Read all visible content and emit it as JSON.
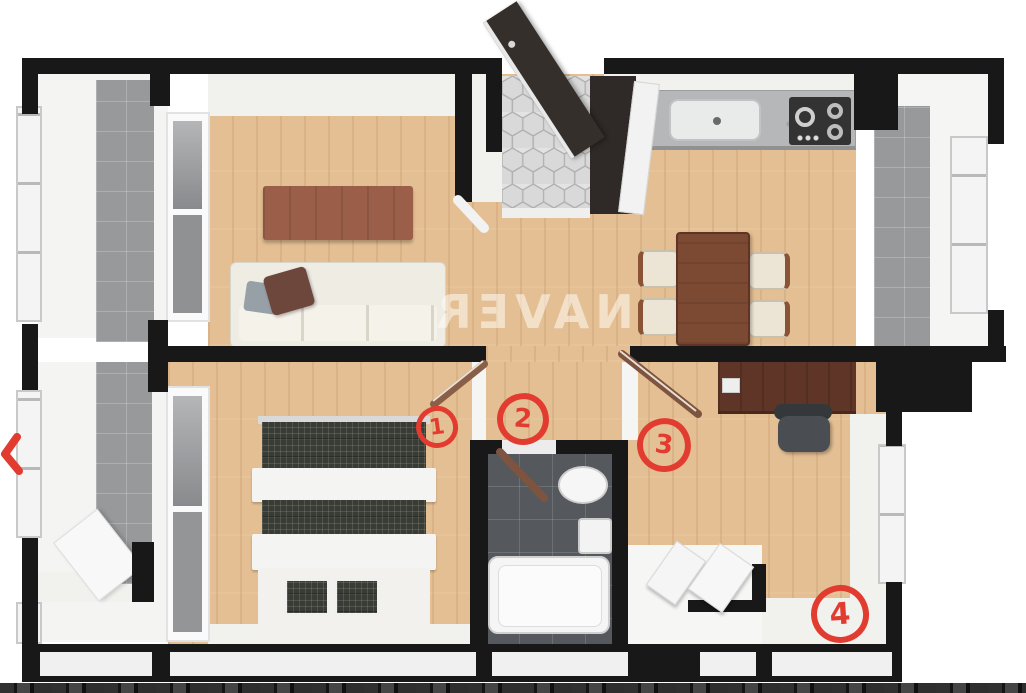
{
  "watermark": {
    "text": "NAVER",
    "mirrored": true
  },
  "annotations": {
    "color": "#e23c30",
    "marks": [
      {
        "label": "1"
      },
      {
        "label": "2"
      },
      {
        "label": "3"
      },
      {
        "label": "4"
      }
    ],
    "arrow_icon": "red-arrow-left-edge"
  },
  "icons": {
    "entrance_door": "open-door-leaf",
    "sink": "kitchen-sink",
    "stove": "gas-cooktop-burners"
  },
  "colors": {
    "wall_black": "#181818",
    "wood_floor": "#e4bf93",
    "bathroom_tile": "#55585c",
    "balcony_tile_gray": "#97999b",
    "entry_hex_tile": "#dcdcdc",
    "annotation_red": "#e23c30",
    "furniture_wood_brown": "#7c4a33",
    "counter_granite": "#b5b7b9"
  }
}
